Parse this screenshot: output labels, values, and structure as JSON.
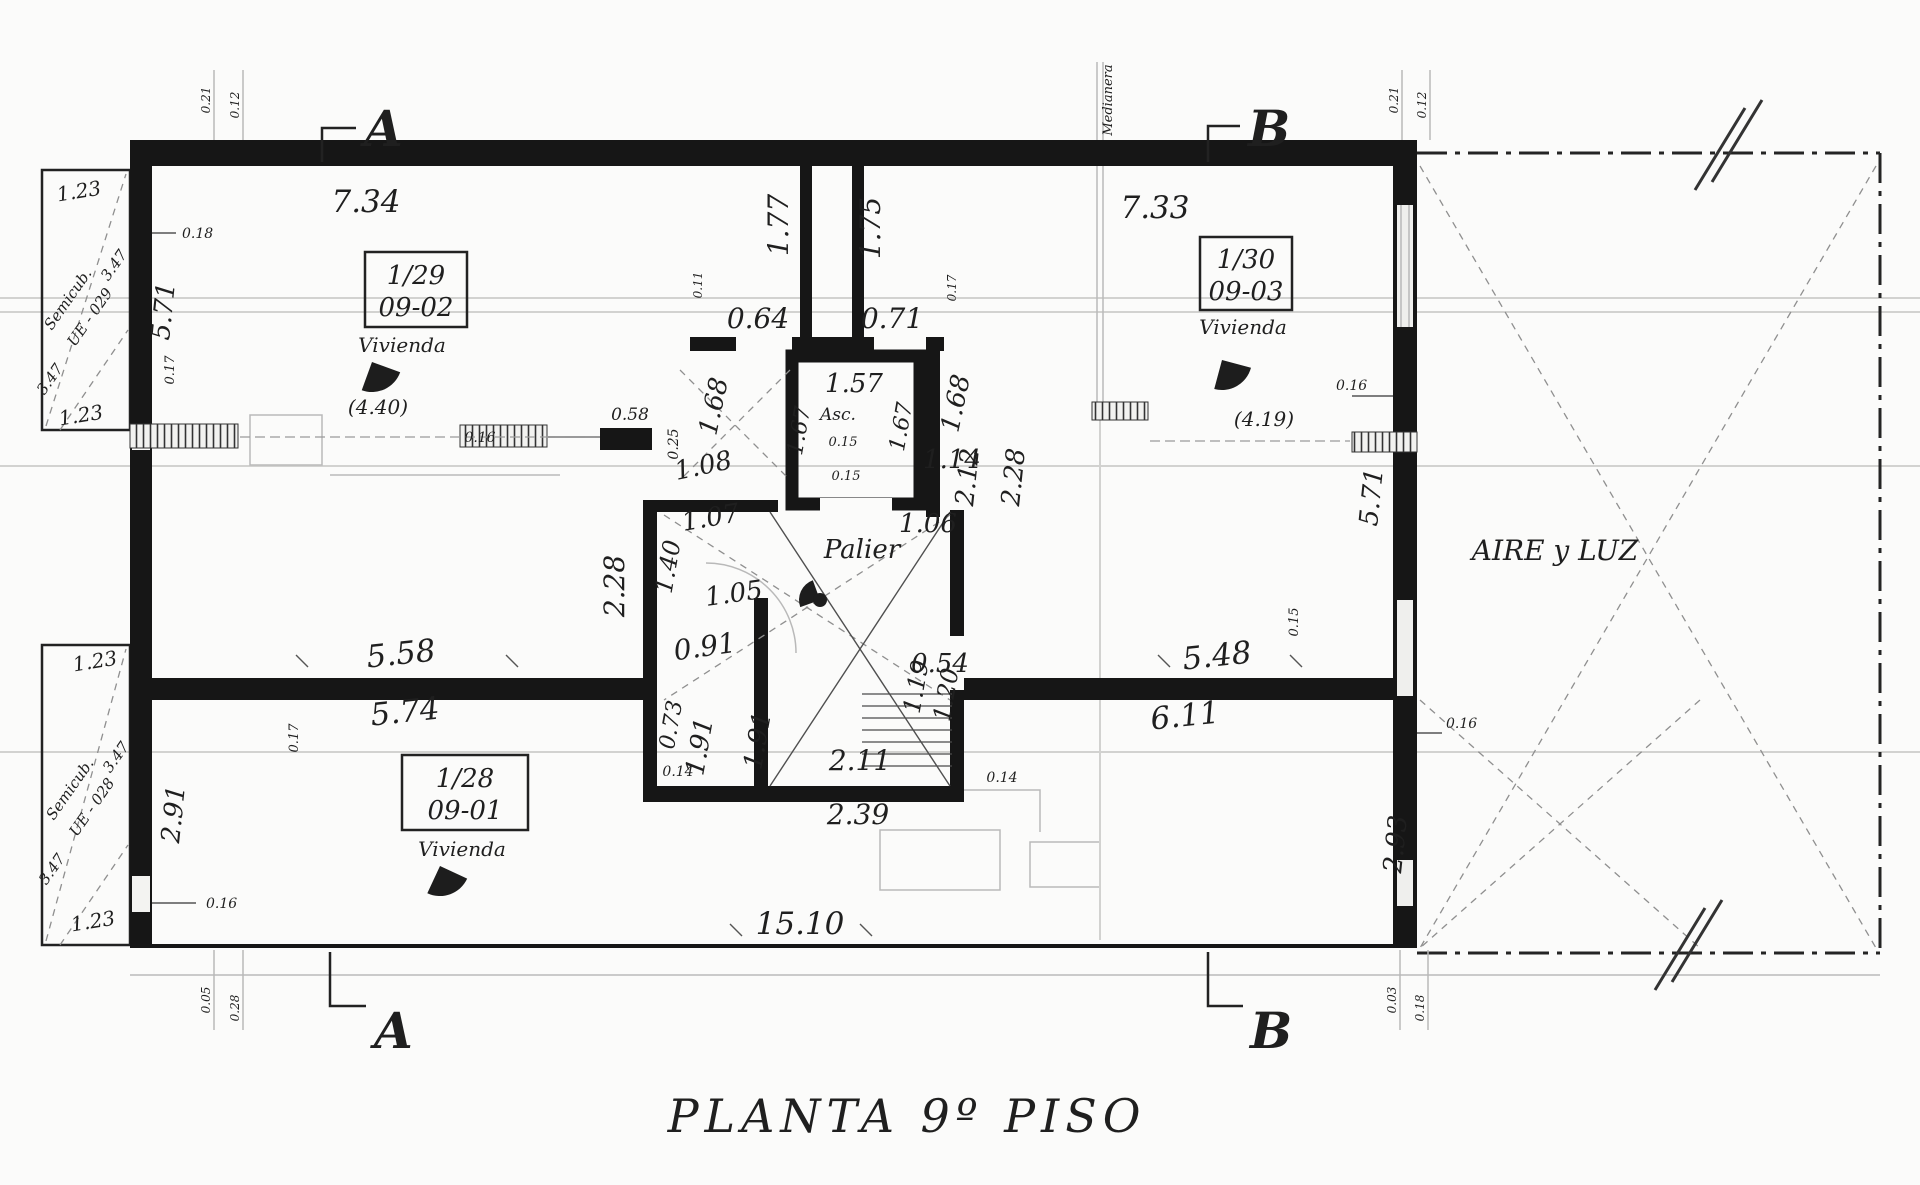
{
  "title": "PLANTA 9º PISO",
  "markers": {
    "section_a": "A",
    "section_b": "B"
  },
  "units": {
    "u29": {
      "lot": "1/29",
      "code": "09-02",
      "type": "Vivienda"
    },
    "u30": {
      "lot": "1/30",
      "code": "09-03",
      "type": "Vivienda"
    },
    "u28": {
      "lot": "1/28",
      "code": "09-01",
      "type": "Vivienda"
    }
  },
  "areas": {
    "landing": "Palier",
    "elevator": "Asc.",
    "light_shaft": "AIRE y LUZ",
    "party_wall": "Medianera",
    "semicub_upper_line1": "Semicub.",
    "semicub_upper_line2": "UE - 029",
    "semicub_lower_line1": "Semicub.",
    "semicub_lower_line2": "UE - 028"
  },
  "dims": {
    "top_left_width": "7.34",
    "top_right_width": "7.33",
    "bottom_width": "15.10",
    "corridor_left": "1.77",
    "corridor_right": "1.75",
    "entry_left": "0.64",
    "entry_right": "0.71",
    "elev_width": "1.57",
    "elev_depth_left": "1.67",
    "elev_depth_right": "1.67",
    "elev_wall_a": "0.15",
    "elev_wall_b": "0.15",
    "flank_left": "1.68",
    "flank_right": "1.68",
    "pier_width": "0.58",
    "pier_thick": "0.25",
    "below_pier": "1.08",
    "beside_elev": "1.14",
    "bath_top": "1.07",
    "bath_left": "1.40",
    "bath_bottom": "1.05",
    "palier_right": "1.06",
    "core_left_height": "2.28",
    "stair_right_a": "2.12",
    "stair_right_b": "2.28",
    "wc_width": "0.91",
    "wc_left": "0.73",
    "stair_door": "0.54",
    "flight_a": "1.91",
    "flight_b": "1.91",
    "flight_c": "1.19",
    "flight_d": "1.20",
    "stair_width": "2.11",
    "stair_outer": "2.39",
    "thin_a": "0.14",
    "thin_b": "0.14",
    "mid_left_top": "5.58",
    "mid_left_bottom": "5.74",
    "mid_right_top": "5.48",
    "mid_right_bottom": "6.11",
    "left_upper_height": "5.71",
    "right_mid_height": "5.71",
    "left_lower_height": "2.91",
    "right_lower_height": "2.93",
    "prot_u_top": "1.23",
    "prot_u_bottom": "1.23",
    "prot_u_side_a": "3.47",
    "prot_u_side_b": "3.47",
    "prot_l_top": "1.23",
    "prot_l_bottom": "1.23",
    "prot_l_side_a": "3.47",
    "prot_l_side_b": "3.47",
    "thk_top_left": "0.18",
    "thk_left_small": "0.17",
    "thk_bottom_left": "0.16",
    "win_left_span": "(4.40)",
    "win_right_span": "(4.19)",
    "win_inner_thk": "0.16",
    "right_wall_thk": "0.16",
    "right_wall_thk2": "0.16",
    "mid_tick_left": "0.17",
    "mid_tick_right": "0.15",
    "shaft_tick_left": "0.11",
    "shaft_tick_right": "0.17",
    "corner_tl_a": "0.21",
    "corner_tl_b": "0.12",
    "corner_tr_a": "0.21",
    "corner_tr_b": "0.12",
    "corner_bl_a": "0.05",
    "corner_bl_b": "0.28",
    "corner_br_a": "0.03",
    "corner_br_b": "0.18"
  },
  "colors": {
    "ink": "#1a1a1a",
    "paper": "#fbfbfa",
    "faint": "#b9b9b9"
  }
}
